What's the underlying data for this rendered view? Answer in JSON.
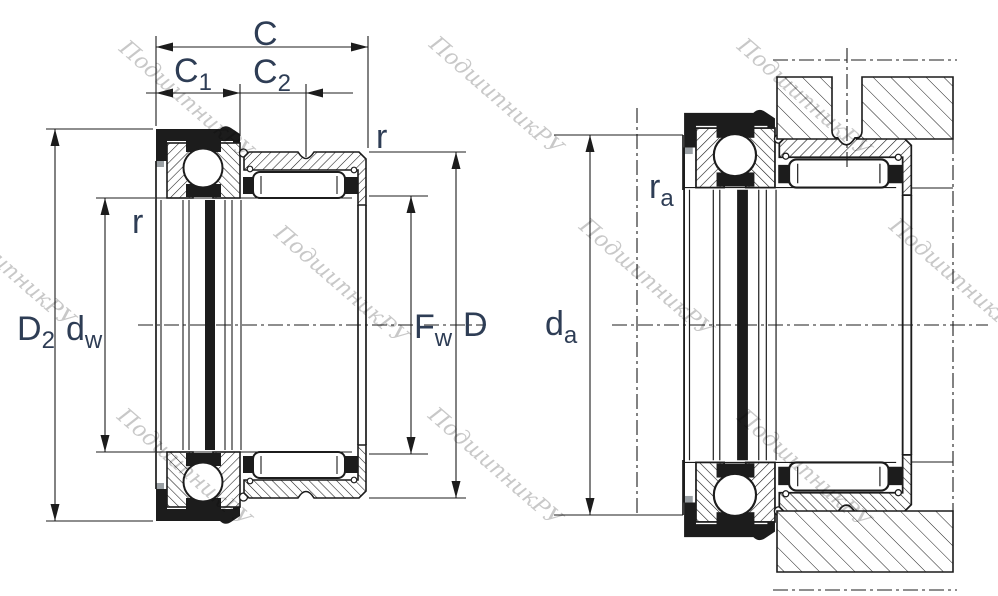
{
  "drawing": {
    "watermark_text": "ПодшипникРУ",
    "colors": {
      "label": "#2e3d55",
      "line": "#1c1c1c",
      "watermark": "#c8c8c8"
    },
    "left_view": {
      "dimension_labels": {
        "c": "C",
        "c1": {
          "base": "C",
          "sub": "1"
        },
        "c2": {
          "base": "C",
          "sub": "2"
        },
        "r_outer": "r",
        "r_inner": "r",
        "d2": {
          "base": "D",
          "sub": "2"
        },
        "dw": {
          "base": "d",
          "sub": "w"
        },
        "fw": {
          "base": "F",
          "sub": "w"
        },
        "d": "D"
      }
    },
    "right_view": {
      "dimension_labels": {
        "ra": {
          "base": "r",
          "sub": "a"
        },
        "da": {
          "base": "d",
          "sub": "a"
        }
      }
    }
  }
}
